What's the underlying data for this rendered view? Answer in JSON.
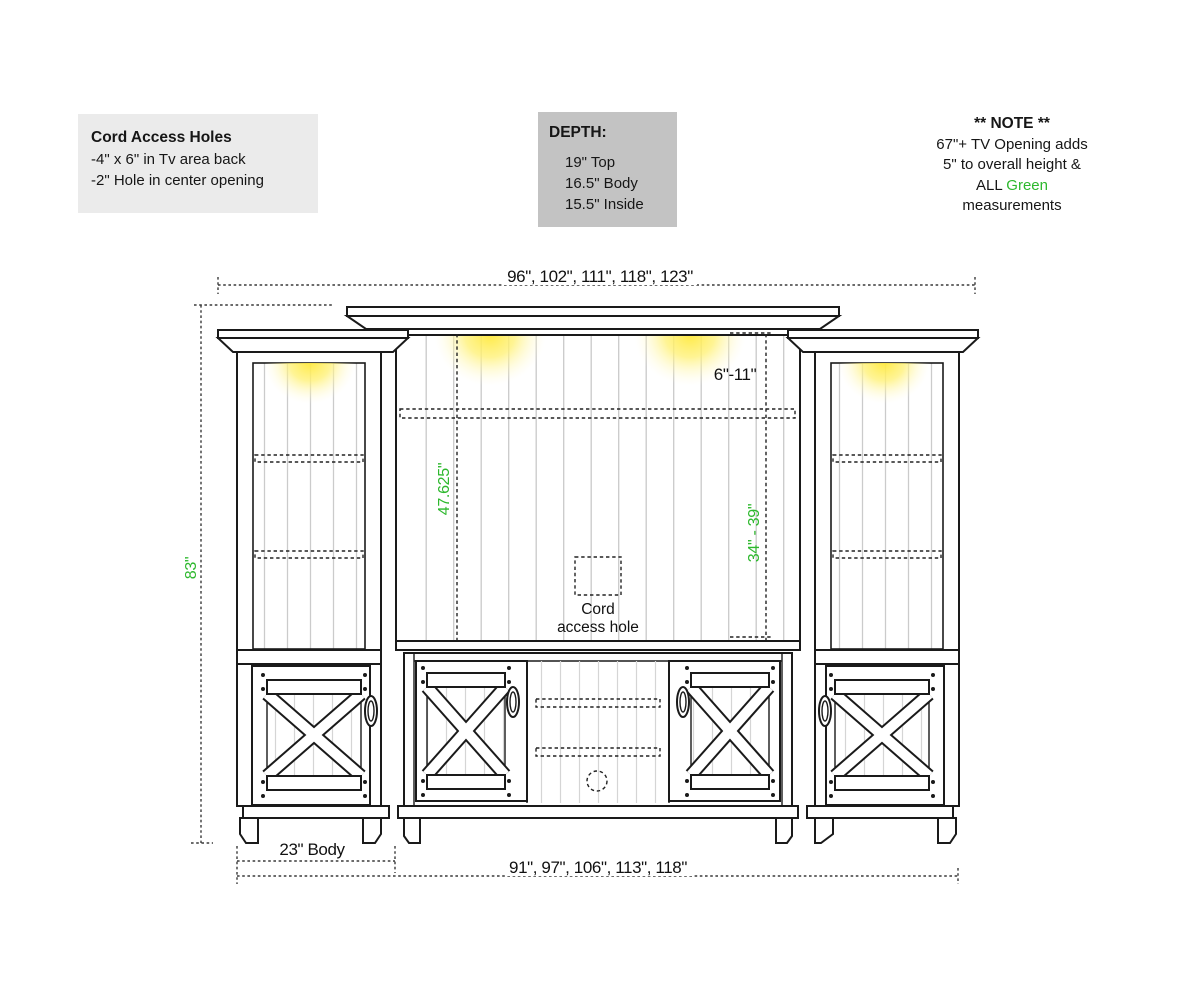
{
  "cord_access_box": {
    "title": "Cord Access Holes",
    "lines": [
      "-4\" x 6\" in Tv area back",
      "-2\" Hole in center opening"
    ]
  },
  "depth_box": {
    "title": "DEPTH:",
    "items": [
      "19\" Top",
      "16.5\" Body",
      "15.5\" Inside"
    ]
  },
  "note": {
    "title": "** NOTE **",
    "line1": "67\"+ TV Opening adds",
    "line2": "5\" to overall height &",
    "line3_black": "ALL",
    "line3_green": "Green",
    "line4": "measurements"
  },
  "dimensions": {
    "top_widths": "96\", 102\", 111\", 118\", 123\"",
    "overall_height": "83\"",
    "tv_opening_height": "47.625\"",
    "side_opening_height": "34\" - 39\"",
    "top_gap": "6\"-11\"",
    "body_width": "23\" Body",
    "bottom_widths": "91\", 97\", 106\", 113\", 118\""
  },
  "labels": {
    "cord_hole_top": "Cord",
    "cord_hole_bottom": "access hole"
  },
  "colors": {
    "green": "#2db82d",
    "line": "#1a1a1a",
    "dim_line": "#3a3a3a",
    "cord_box_bg": "#ebebeb",
    "depth_box_bg": "#c3c3c3",
    "glow_yellow": "#ffe93e",
    "plank_gray": "#c9c9c9"
  }
}
